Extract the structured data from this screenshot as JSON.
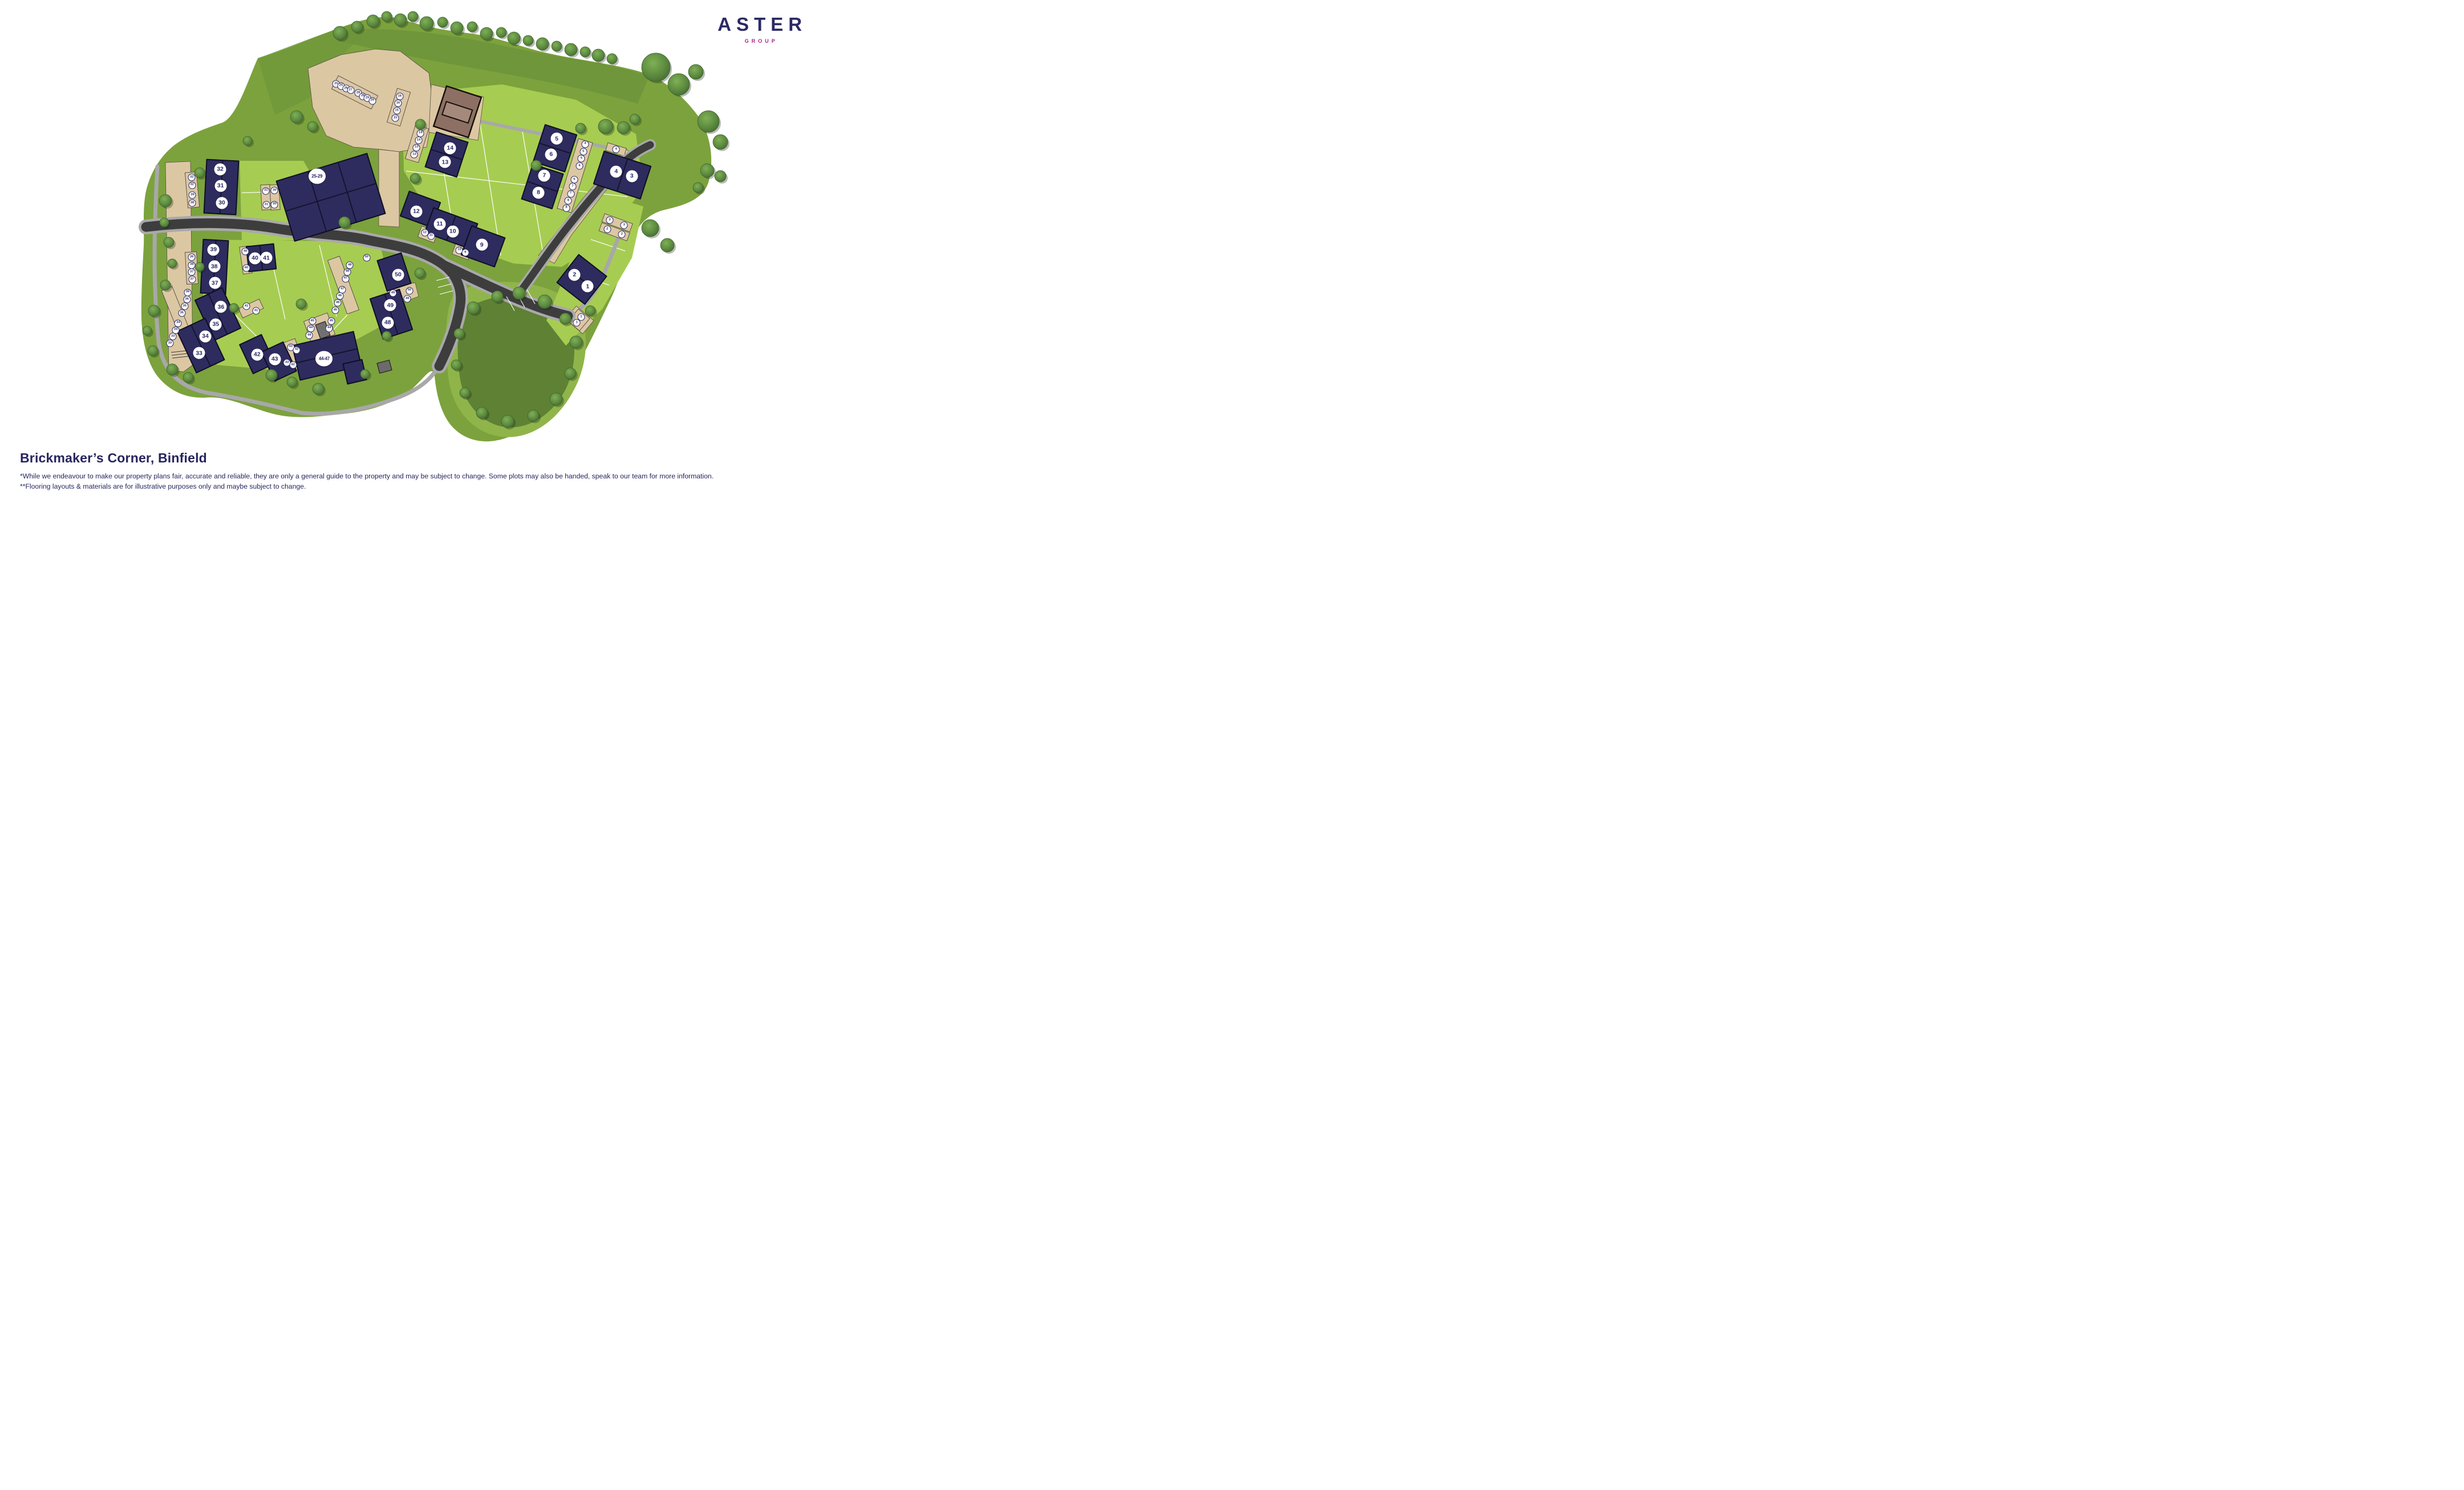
{
  "brand": {
    "name": "ASTER",
    "subname": "GROUP",
    "name_color": "#2b2a64",
    "subname_color": "#a9208e"
  },
  "title": "Brickmaker’s Corner, Binfield",
  "disclaimer_line1": "*While we endeavour to make our property plans fair, accurate and reliable, they are only a general guide to the property and may be subject to change. Some plots may also be handed, speak to our team for more information.",
  "disclaimer_line2": "**Flooring layouts & materials are for illustrative purposes only and maybe subject to change.",
  "colors": {
    "navy_text": "#2b2a64",
    "magenta": "#a9208e",
    "building": "#2e2c5e",
    "road": "#3d3d3d",
    "pavement": "#a9a9a9",
    "parking_beige": "#dcc7a3",
    "grass": "#7ca23d",
    "lawn": "#a7cc52",
    "pond": "#5e8134",
    "tree": "#5c8a3f",
    "garage_brown": "#8d7063"
  },
  "plot_markers": [
    {
      "label": "1",
      "x": 71.55,
      "y": 57.67
    },
    {
      "label": "2",
      "x": 69.95,
      "y": 55.34
    },
    {
      "label": "3",
      "x": 76.92,
      "y": 35.48
    },
    {
      "label": "4",
      "x": 75.02,
      "y": 34.56
    },
    {
      "label": "5",
      "x": 67.78,
      "y": 27.93
    },
    {
      "label": "6",
      "x": 67.1,
      "y": 31.11
    },
    {
      "label": "7",
      "x": 66.27,
      "y": 35.36
    },
    {
      "label": "8",
      "x": 65.56,
      "y": 38.81
    },
    {
      "label": "9",
      "x": 58.66,
      "y": 49.29
    },
    {
      "label": "10",
      "x": 55.12,
      "y": 46.61
    },
    {
      "label": "11",
      "x": 53.54,
      "y": 45.12
    },
    {
      "label": "12",
      "x": 50.69,
      "y": 42.6
    },
    {
      "label": "13",
      "x": 54.19,
      "y": 32.64
    },
    {
      "label": "14",
      "x": 54.81,
      "y": 29.85
    },
    {
      "label": "25-29",
      "x": 38.59,
      "y": 35.48
    },
    {
      "label": "30",
      "x": 27.01,
      "y": 40.87
    },
    {
      "label": "31",
      "x": 26.85,
      "y": 37.43
    },
    {
      "label": "32",
      "x": 26.81,
      "y": 34.06
    },
    {
      "label": "33",
      "x": 24.24,
      "y": 71.1
    },
    {
      "label": "34",
      "x": 25.0,
      "y": 67.74
    },
    {
      "label": "35",
      "x": 26.27,
      "y": 65.33
    },
    {
      "label": "36",
      "x": 26.9,
      "y": 61.8
    },
    {
      "label": "37",
      "x": 26.16,
      "y": 56.98
    },
    {
      "label": "38",
      "x": 26.09,
      "y": 53.65
    },
    {
      "label": "39",
      "x": 25.99,
      "y": 50.29
    },
    {
      "label": "40",
      "x": 31.04,
      "y": 51.97
    },
    {
      "label": "41",
      "x": 32.43,
      "y": 51.93
    },
    {
      "label": "42",
      "x": 31.3,
      "y": 71.38
    },
    {
      "label": "43",
      "x": 33.45,
      "y": 72.33
    },
    {
      "label": "44-47",
      "x": 39.47,
      "y": 72.25
    },
    {
      "label": "48",
      "x": 47.2,
      "y": 64.95
    },
    {
      "label": "49",
      "x": 47.52,
      "y": 61.46
    },
    {
      "label": "50",
      "x": 48.47,
      "y": 55.3
    }
  ],
  "parking_markers": [
    {
      "label": "25",
      "x": 40.93,
      "y": 16.88
    },
    {
      "label": "25",
      "x": 41.53,
      "y": 17.3
    },
    {
      "label": "26",
      "x": 42.13,
      "y": 17.83
    },
    {
      "label": "27",
      "x": 42.69,
      "y": 18.14
    },
    {
      "label": "28",
      "x": 43.61,
      "y": 18.71
    },
    {
      "label": "28",
      "x": 44.17,
      "y": 19.37
    },
    {
      "label": "29",
      "x": 44.72,
      "y": 19.75
    },
    {
      "label": "29",
      "x": 45.32,
      "y": 20.28
    },
    {
      "label": "16",
      "x": 48.66,
      "y": 19.4
    },
    {
      "label": "16",
      "x": 48.47,
      "y": 20.82
    },
    {
      "label": "15",
      "x": 48.31,
      "y": 22.27
    },
    {
      "label": "15",
      "x": 48.13,
      "y": 23.77
    },
    {
      "label": "14",
      "x": 51.2,
      "y": 26.83
    },
    {
      "label": "14",
      "x": 50.97,
      "y": 28.24
    },
    {
      "label": "13",
      "x": 50.72,
      "y": 29.7
    },
    {
      "label": "13",
      "x": 50.44,
      "y": 31.15
    },
    {
      "label": "4",
      "x": 71.25,
      "y": 29.01
    },
    {
      "label": "5",
      "x": 71.02,
      "y": 30.54
    },
    {
      "label": "5",
      "x": 70.79,
      "y": 31.95
    },
    {
      "label": "6",
      "x": 70.56,
      "y": 33.45
    },
    {
      "label": "6",
      "x": 69.93,
      "y": 36.17
    },
    {
      "label": "7",
      "x": 69.72,
      "y": 37.58
    },
    {
      "label": "7",
      "x": 69.49,
      "y": 39.0
    },
    {
      "label": "8",
      "x": 69.19,
      "y": 40.45
    },
    {
      "label": "8",
      "x": 68.96,
      "y": 41.87
    },
    {
      "label": "4",
      "x": 75.02,
      "y": 30.08
    },
    {
      "label": "3",
      "x": 74.24,
      "y": 44.32
    },
    {
      "label": "3",
      "x": 75.99,
      "y": 45.35
    },
    {
      "label": "2",
      "x": 73.94,
      "y": 46.19
    },
    {
      "label": "2",
      "x": 75.72,
      "y": 47.19
    },
    {
      "label": "32",
      "x": 23.35,
      "y": 35.74
    },
    {
      "label": "32",
      "x": 23.38,
      "y": 37.28
    },
    {
      "label": "39",
      "x": 23.43,
      "y": 39.3
    },
    {
      "label": "38",
      "x": 23.4,
      "y": 40.87
    },
    {
      "label": "31",
      "x": 32.38,
      "y": 38.42
    },
    {
      "label": "31",
      "x": 32.41,
      "y": 41.22
    },
    {
      "label": "30",
      "x": 33.43,
      "y": 38.38
    },
    {
      "label": "30",
      "x": 33.43,
      "y": 41.18
    },
    {
      "label": "12",
      "x": 51.71,
      "y": 46.84
    },
    {
      "label": "11",
      "x": 52.48,
      "y": 47.5
    },
    {
      "label": "10",
      "x": 55.93,
      "y": 50.37
    },
    {
      "label": "9",
      "x": 56.65,
      "y": 50.86
    },
    {
      "label": "1",
      "x": 70.76,
      "y": 63.87
    },
    {
      "label": "1",
      "x": 70.23,
      "y": 65.02
    },
    {
      "label": "39",
      "x": 23.33,
      "y": 51.81
    },
    {
      "label": "38",
      "x": 23.35,
      "y": 53.35
    },
    {
      "label": "37",
      "x": 23.35,
      "y": 54.76
    },
    {
      "label": "37",
      "x": 23.38,
      "y": 56.26
    },
    {
      "label": "40",
      "x": 29.88,
      "y": 50.67
    },
    {
      "label": "40",
      "x": 29.98,
      "y": 54.0
    },
    {
      "label": "41",
      "x": 30.0,
      "y": 61.65
    },
    {
      "label": "41",
      "x": 31.18,
      "y": 62.61
    },
    {
      "label": "36",
      "x": 22.85,
      "y": 58.86
    },
    {
      "label": "36",
      "x": 22.76,
      "y": 60.31
    },
    {
      "label": "35",
      "x": 22.48,
      "y": 61.69
    },
    {
      "label": "35",
      "x": 22.13,
      "y": 63.07
    },
    {
      "label": "34",
      "x": 21.69,
      "y": 65.06
    },
    {
      "label": "34",
      "x": 21.39,
      "y": 66.44
    },
    {
      "label": "33",
      "x": 21.06,
      "y": 67.74
    },
    {
      "label": "33",
      "x": 20.69,
      "y": 69.15
    },
    {
      "label": "50",
      "x": 44.63,
      "y": 51.86
    },
    {
      "label": "48",
      "x": 42.59,
      "y": 53.39
    },
    {
      "label": "48",
      "x": 42.29,
      "y": 54.73
    },
    {
      "label": "47",
      "x": 42.08,
      "y": 56.11
    },
    {
      "label": "47",
      "x": 41.69,
      "y": 58.29
    },
    {
      "label": "46",
      "x": 41.39,
      "y": 59.62
    },
    {
      "label": "46",
      "x": 41.13,
      "y": 61.0
    },
    {
      "label": "45",
      "x": 40.83,
      "y": 62.49
    },
    {
      "label": "45",
      "x": 40.35,
      "y": 64.67
    },
    {
      "label": "44",
      "x": 40.09,
      "y": 66.1
    },
    {
      "label": "45",
      "x": 38.03,
      "y": 64.67
    },
    {
      "label": "44",
      "x": 37.85,
      "y": 66.1
    },
    {
      "label": "44",
      "x": 37.66,
      "y": 67.55
    },
    {
      "label": "43",
      "x": 35.4,
      "y": 69.89
    },
    {
      "label": "42",
      "x": 36.13,
      "y": 70.46
    },
    {
      "label": "43",
      "x": 34.95,
      "y": 73.02
    },
    {
      "label": "42",
      "x": 35.67,
      "y": 73.52
    },
    {
      "label": "49",
      "x": 47.85,
      "y": 59.01
    },
    {
      "label": "50",
      "x": 49.84,
      "y": 58.52
    },
    {
      "label": "49",
      "x": 49.6,
      "y": 60.2
    }
  ]
}
